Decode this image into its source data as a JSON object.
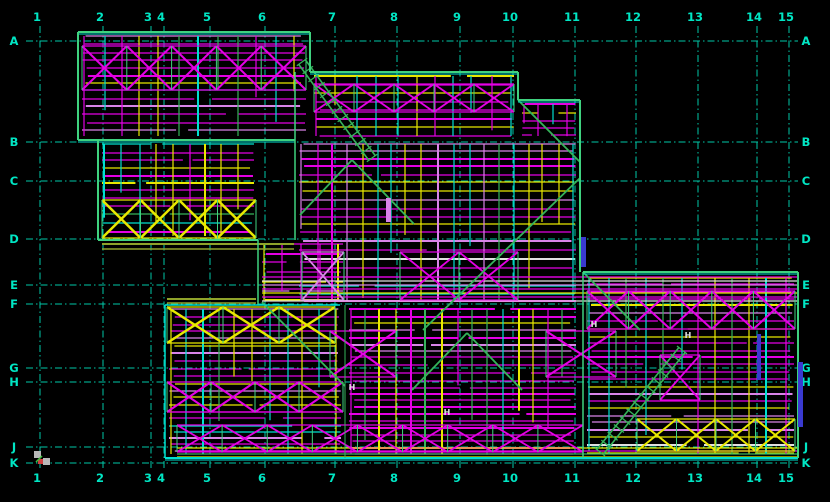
{
  "app": {
    "type": "cad-framing-plan",
    "background": "#000000"
  },
  "grid": {
    "line_color": "#00c9a8",
    "label_color": "#00e6c4",
    "label_size": 11.5,
    "columns": [
      {
        "label": "1",
        "x": 40
      },
      {
        "label": "2",
        "x": 103
      },
      {
        "label": "3",
        "x": 151
      },
      {
        "label": "4",
        "x": 164
      },
      {
        "label": "5",
        "x": 210
      },
      {
        "label": "6",
        "x": 265
      },
      {
        "label": "7",
        "x": 335
      },
      {
        "label": "8",
        "x": 397
      },
      {
        "label": "9",
        "x": 460
      },
      {
        "label": "10",
        "x": 513
      },
      {
        "label": "11",
        "x": 575
      },
      {
        "label": "12",
        "x": 636
      },
      {
        "label": "13",
        "x": 698
      },
      {
        "label": "14",
        "x": 757
      },
      {
        "label": "15",
        "x": 789
      }
    ],
    "rows": [
      {
        "label": "A",
        "y": 41
      },
      {
        "label": "B",
        "y": 142
      },
      {
        "label": "C",
        "y": 181
      },
      {
        "label": "D",
        "y": 239
      },
      {
        "label": "E",
        "y": 285
      },
      {
        "label": "F",
        "y": 304
      },
      {
        "label": "G",
        "y": 368
      },
      {
        "label": "H",
        "y": 382
      },
      {
        "label": "J",
        "y": 447
      },
      {
        "label": "K",
        "y": 463
      }
    ],
    "top_label_y": 21,
    "bottom_label_y": 482,
    "left_label_x": 14,
    "right_label_x": 806,
    "v_extent": [
      26,
      471
    ],
    "h_extent": [
      26,
      798
    ]
  },
  "palette": {
    "magenta": "#e400e4",
    "violet": "#d983e8",
    "yellow": "#e8e800",
    "cyan": "#00dfd0",
    "green": "#35b35a",
    "edge": "#3fd27f",
    "edge2": "#00e0d0",
    "olive": "#8fa32a",
    "white": "#e0e0e0",
    "orange": "#e09a00",
    "blue": "#3a3ad0",
    "red": "#d04040",
    "gray": "#b8b8b8"
  },
  "drawing": {
    "edges": [
      {
        "x1": 78,
        "y1": 32,
        "x2": 310,
        "y2": 32,
        "c": "edge",
        "w": 2,
        "dbl": true
      },
      {
        "x1": 78,
        "y1": 32,
        "x2": 78,
        "y2": 140,
        "c": "edge",
        "w": 2
      },
      {
        "x1": 78,
        "y1": 140,
        "x2": 295,
        "y2": 140,
        "c": "edge",
        "w": 2,
        "dbl": true
      },
      {
        "x1": 310,
        "y1": 32,
        "x2": 310,
        "y2": 72,
        "c": "edge",
        "w": 2
      },
      {
        "x1": 310,
        "y1": 72,
        "x2": 518,
        "y2": 72,
        "c": "edge",
        "w": 2,
        "dbl": true
      },
      {
        "x1": 518,
        "y1": 72,
        "x2": 518,
        "y2": 100,
        "c": "edge",
        "w": 2
      },
      {
        "x1": 518,
        "y1": 100,
        "x2": 580,
        "y2": 100,
        "c": "edge",
        "w": 2,
        "dbl": true
      },
      {
        "x1": 580,
        "y1": 100,
        "x2": 580,
        "y2": 272,
        "c": "edge",
        "w": 2
      },
      {
        "x1": 98,
        "y1": 140,
        "x2": 98,
        "y2": 240,
        "c": "edge",
        "w": 2
      },
      {
        "x1": 98,
        "y1": 240,
        "x2": 258,
        "y2": 240,
        "c": "edge",
        "w": 2
      },
      {
        "x1": 102,
        "y1": 244,
        "x2": 294,
        "y2": 244,
        "c": "olive",
        "w": 2
      },
      {
        "x1": 102,
        "y1": 249,
        "x2": 294,
        "y2": 249,
        "c": "olive",
        "w": 1.5
      },
      {
        "x1": 258,
        "y1": 240,
        "x2": 258,
        "y2": 305,
        "c": "edge",
        "w": 1.5
      },
      {
        "x1": 295,
        "y1": 72,
        "x2": 295,
        "y2": 240,
        "c": "edge",
        "w": 1.5
      },
      {
        "x1": 167,
        "y1": 299,
        "x2": 256,
        "y2": 299,
        "c": "olive",
        "w": 2
      },
      {
        "x1": 167,
        "y1": 303,
        "x2": 256,
        "y2": 303,
        "c": "olive",
        "w": 1.5
      },
      {
        "x1": 165,
        "y1": 305,
        "x2": 340,
        "y2": 305,
        "c": "edge2",
        "w": 1.5
      },
      {
        "x1": 165,
        "y1": 305,
        "x2": 165,
        "y2": 458,
        "c": "edge2",
        "w": 1.5
      },
      {
        "x1": 165,
        "y1": 458,
        "x2": 798,
        "y2": 458,
        "c": "edge2",
        "w": 2,
        "dbl": true
      },
      {
        "x1": 583,
        "y1": 272,
        "x2": 798,
        "y2": 272,
        "c": "edge",
        "w": 2,
        "dbl": true
      },
      {
        "x1": 798,
        "y1": 272,
        "x2": 798,
        "y2": 458,
        "c": "edge",
        "w": 2
      },
      {
        "x1": 583,
        "y1": 272,
        "x2": 583,
        "y2": 458,
        "c": "edge",
        "w": 1.5
      },
      {
        "x1": 345,
        "y1": 305,
        "x2": 345,
        "y2": 458,
        "c": "green",
        "w": 1
      }
    ],
    "zones": [
      {
        "x": 80,
        "y": 34,
        "w": 228,
        "h": 104,
        "hsp": 7,
        "vsp": 17,
        "seed": 11,
        "hc": [
          [
            "magenta",
            0.5
          ],
          [
            "violet",
            0.16
          ],
          [
            "yellow",
            0.14
          ],
          [
            "cyan",
            0.12
          ],
          [
            "white",
            0.08
          ]
        ],
        "vc": [
          [
            "yellow",
            0.38
          ],
          [
            "cyan",
            0.3
          ],
          [
            "magenta",
            0.24
          ],
          [
            "green",
            0.08
          ]
        ]
      },
      {
        "x": 100,
        "y": 142,
        "w": 156,
        "h": 96,
        "hsp": 7,
        "vsp": 15,
        "seed": 22,
        "hc": [
          [
            "magenta",
            0.45
          ],
          [
            "cyan",
            0.2
          ],
          [
            "yellow",
            0.2
          ],
          [
            "green",
            0.15
          ]
        ],
        "vc": [
          [
            "cyan",
            0.4
          ],
          [
            "yellow",
            0.3
          ],
          [
            "magenta",
            0.3
          ]
        ]
      },
      {
        "x": 167,
        "y": 307,
        "w": 176,
        "h": 149,
        "hsp": 6,
        "vsp": 14,
        "seed": 33,
        "hc": [
          [
            "magenta",
            0.55
          ],
          [
            "violet",
            0.2
          ],
          [
            "yellow",
            0.15
          ],
          [
            "cyan",
            0.1
          ]
        ],
        "vc": [
          [
            "cyan",
            0.35
          ],
          [
            "yellow",
            0.3
          ],
          [
            "magenta",
            0.25
          ],
          [
            "green",
            0.1
          ]
        ]
      },
      {
        "x": 312,
        "y": 74,
        "w": 204,
        "h": 64,
        "hsp": 8,
        "vsp": 18,
        "seed": 44,
        "hc": [
          [
            "magenta",
            0.6
          ],
          [
            "cyan",
            0.2
          ],
          [
            "yellow",
            0.2
          ]
        ],
        "vc": [
          [
            "cyan",
            0.4
          ],
          [
            "yellow",
            0.3
          ],
          [
            "magenta",
            0.3
          ]
        ]
      },
      {
        "x": 297,
        "y": 142,
        "w": 281,
        "h": 161,
        "hsp": 7,
        "vsp": 13,
        "seed": 55,
        "hc": [
          [
            "magenta",
            0.42
          ],
          [
            "violet",
            0.2
          ],
          [
            "yellow",
            0.16
          ],
          [
            "cyan",
            0.1
          ],
          [
            "white",
            0.06
          ],
          [
            "orange",
            0.06
          ]
        ],
        "vc": [
          [
            "cyan",
            0.26
          ],
          [
            "yellow",
            0.26
          ],
          [
            "magenta",
            0.24
          ],
          [
            "green",
            0.14
          ],
          [
            "violet",
            0.1
          ]
        ]
      },
      {
        "x": 347,
        "y": 307,
        "w": 231,
        "h": 149,
        "hsp": 6,
        "vsp": 13,
        "seed": 66,
        "hc": [
          [
            "magenta",
            0.58
          ],
          [
            "violet",
            0.2
          ],
          [
            "green",
            0.1
          ],
          [
            "yellow",
            0.12
          ]
        ],
        "vc": [
          [
            "green",
            0.3
          ],
          [
            "cyan",
            0.25
          ],
          [
            "magenta",
            0.22
          ],
          [
            "yellow",
            0.23
          ]
        ]
      },
      {
        "x": 520,
        "y": 102,
        "w": 58,
        "h": 36,
        "hsp": 7,
        "vsp": 12,
        "seed": 77,
        "hc": [
          [
            "magenta",
            0.7
          ],
          [
            "yellow",
            0.3
          ]
        ],
        "vc": [
          [
            "magenta",
            0.5
          ],
          [
            "cyan",
            0.5
          ]
        ]
      },
      {
        "x": 585,
        "y": 276,
        "w": 211,
        "h": 180,
        "hsp": 6,
        "vsp": 16,
        "seed": 88,
        "hc": [
          [
            "magenta",
            0.52
          ],
          [
            "violet",
            0.25
          ],
          [
            "yellow",
            0.11
          ],
          [
            "white",
            0.12
          ]
        ],
        "vc": [
          [
            "green",
            0.35
          ],
          [
            "cyan",
            0.3
          ],
          [
            "magenta",
            0.17
          ],
          [
            "yellow",
            0.18
          ]
        ]
      },
      {
        "x": 260,
        "y": 242,
        "w": 85,
        "h": 61,
        "hsp": 8,
        "vsp": 15,
        "seed": 99,
        "hc": [
          [
            "magenta",
            0.5
          ],
          [
            "violet",
            0.3
          ],
          [
            "yellow",
            0.2
          ]
        ],
        "vc": [
          [
            "cyan",
            0.4
          ],
          [
            "magenta",
            0.3
          ],
          [
            "yellow",
            0.3
          ]
        ]
      }
    ],
    "xrows": [
      {
        "x0": 82,
        "x1": 306,
        "y0": 46,
        "y1": 90,
        "n": 5,
        "c": "magenta",
        "w": 2
      },
      {
        "x0": 102,
        "x1": 256,
        "y0": 200,
        "y1": 238,
        "n": 4,
        "c": "yellow",
        "w": 2.5
      },
      {
        "x0": 167,
        "x1": 335,
        "y0": 307,
        "y1": 343,
        "n": 3,
        "c": "yellow",
        "w": 2.5
      },
      {
        "x0": 167,
        "x1": 343,
        "y0": 382,
        "y1": 412,
        "n": 4,
        "c": "magenta",
        "w": 2
      },
      {
        "x0": 177,
        "x1": 583,
        "y0": 425,
        "y1": 452,
        "n": 9,
        "c": "magenta",
        "w": 1.8
      },
      {
        "x0": 587,
        "x1": 795,
        "y0": 291,
        "y1": 329,
        "n": 5,
        "c": "magenta",
        "w": 2
      },
      {
        "x0": 637,
        "x1": 795,
        "y0": 419,
        "y1": 451,
        "n": 4,
        "c": "yellow",
        "w": 2
      },
      {
        "x0": 314,
        "x1": 514,
        "y0": 84,
        "y1": 112,
        "n": 5,
        "c": "magenta",
        "w": 1.8
      },
      {
        "x0": 400,
        "x1": 518,
        "y0": 252,
        "y1": 300,
        "n": 2,
        "c": "magenta",
        "w": 1.8
      },
      {
        "x0": 302,
        "x1": 344,
        "y0": 252,
        "y1": 300,
        "n": 1,
        "c": "violet",
        "w": 1.8
      },
      {
        "x0": 330,
        "x1": 396,
        "y0": 331,
        "y1": 377,
        "n": 1,
        "c": "magenta",
        "w": 2
      },
      {
        "x0": 546,
        "x1": 616,
        "y0": 331,
        "y1": 377,
        "n": 1,
        "c": "magenta",
        "w": 2
      },
      {
        "x0": 660,
        "x1": 700,
        "y0": 355,
        "y1": 400,
        "n": 1,
        "c": "magenta",
        "w": 1.8
      }
    ],
    "ladders": [
      {
        "x1": 302,
        "y1": 62,
        "x2": 372,
        "y2": 158,
        "rungs": 12
      },
      {
        "x1": 600,
        "y1": 452,
        "x2": 682,
        "y2": 350,
        "rungs": 13
      }
    ],
    "diagonals": [
      {
        "x1": 518,
        "y1": 100,
        "x2": 580,
        "y2": 162
      },
      {
        "x1": 423,
        "y1": 330,
        "x2": 580,
        "y2": 178
      },
      {
        "x1": 352,
        "y1": 160,
        "x2": 300,
        "y2": 215
      },
      {
        "x1": 352,
        "y1": 160,
        "x2": 414,
        "y2": 224
      },
      {
        "x1": 467,
        "y1": 333,
        "x2": 412,
        "y2": 390
      },
      {
        "x1": 467,
        "y1": 333,
        "x2": 522,
        "y2": 390
      },
      {
        "x1": 262,
        "y1": 302,
        "x2": 345,
        "y2": 386
      },
      {
        "x1": 583,
        "y1": 272,
        "x2": 640,
        "y2": 330
      }
    ],
    "bands": [
      {
        "x0": 262,
        "x1": 797,
        "y0": 277,
        "y1": 301,
        "sp": 4,
        "colors": [
          "magenta",
          "white",
          "violet",
          "magenta",
          "yellow"
        ]
      },
      {
        "x0": 177,
        "x1": 797,
        "y0": 448,
        "y1": 457,
        "sp": 3,
        "colors": [
          "yellow",
          "magenta",
          "green"
        ]
      }
    ],
    "bars": [
      {
        "x": 581,
        "y": 237,
        "w": 5,
        "h": 30,
        "c": "blue"
      },
      {
        "x": 798,
        "y": 362,
        "w": 5,
        "h": 65,
        "c": "blue"
      },
      {
        "x": 757,
        "y": 334,
        "w": 4,
        "h": 46,
        "c": "blue"
      },
      {
        "x": 386,
        "y": 198,
        "w": 5,
        "h": 24,
        "c": "violet"
      }
    ],
    "h_marks": [
      {
        "label": "H",
        "x": 352,
        "y": 390
      },
      {
        "label": "H",
        "x": 447,
        "y": 415
      },
      {
        "label": "H",
        "x": 594,
        "y": 327
      },
      {
        "label": "H",
        "x": 688,
        "y": 338
      }
    ],
    "origin_marker": {
      "x": 36,
      "y": 452,
      "gray": "#b8b8b8",
      "red": "#d04040",
      "green": "#40c040"
    }
  }
}
